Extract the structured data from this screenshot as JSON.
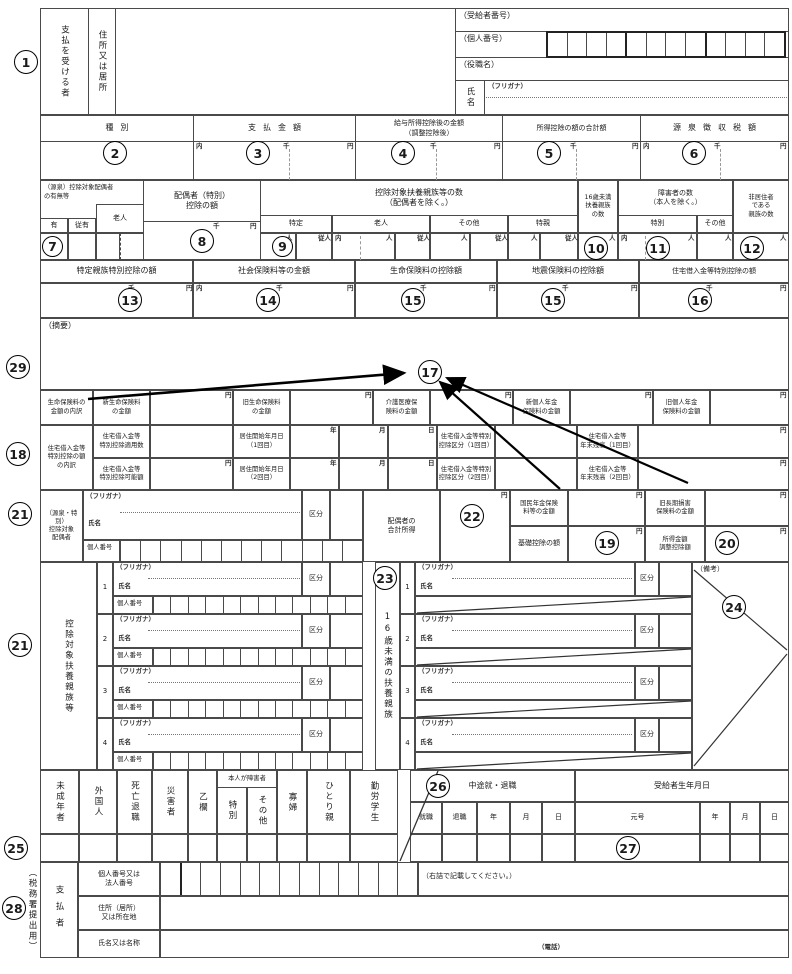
{
  "markers": {
    "m1": "1",
    "m2": "2",
    "m3": "3",
    "m4": "4",
    "m5": "5",
    "m6": "6",
    "m7": "7",
    "m8": "8",
    "m9": "9",
    "m10": "10",
    "m11": "11",
    "m12": "12",
    "m13": "13",
    "m14": "14",
    "m15": "15",
    "m16": "16",
    "m17": "17",
    "m18": "18",
    "m19": "19",
    "m20": "20",
    "m21": "21",
    "m22": "22",
    "m23": "23",
    "m24": "24",
    "m25": "25",
    "m26": "26",
    "m27": "27",
    "m28": "28",
    "m29": "29"
  },
  "units": {
    "uchi": "内",
    "sen": "千",
    "yen": "円",
    "nin": "人",
    "junin": "従人",
    "nen": "年",
    "tsuki": "月",
    "hi": "日"
  },
  "common": {
    "furigana": "（フリガナ）",
    "shimei": "氏名",
    "kojin_bango": "個人番号",
    "kubun": "区分"
  },
  "recipient": {
    "payee": "支払を受ける者",
    "address": "住所又は居所",
    "recipient_no": "（受給者番号）",
    "personal_no": "（個人番号）",
    "position": "（役職名）",
    "name": "氏名"
  },
  "pay": {
    "type": "種別",
    "amount": "支払金額",
    "after_deduction": "給与所得控除後の金額\n（調整控除後）",
    "total_deductions": "所得控除の額の合計額",
    "withheld_tax": "源泉徴収税額"
  },
  "household": {
    "spouse_status": "（源泉）控除対象配偶者\nの有無等",
    "rojin": "老人",
    "ari": "有",
    "juari": "従有",
    "spouse_deduction": "配偶者（特別）\n控除の額",
    "dependents_count": "控除対象扶養親族等の数\n（配偶者を除く。）",
    "tokutei": "特定",
    "sonota": "その他",
    "tokushin": "特親",
    "under16": "16歳未満\n扶養親族\nの数",
    "disabled": "障害者の数\n（本人を除く。）",
    "tokubetsu": "特別",
    "nonresident": "非居住者\nである\n親族の数"
  },
  "deductions": {
    "tokutei_shinzoku": "特定親族特別控除の額",
    "shakai_hoken": "社会保険料等の金額",
    "seimei_hoken": "生命保険料の控除額",
    "jishin_hoken": "地震保険料の控除額",
    "jutaku": "住宅借入金等特別控除の額"
  },
  "summary": {
    "label": "（摘要）"
  },
  "insurance": {
    "breakdown": "生命保険料の\n金額の内訳",
    "shin_seimei": "新生命保険料\nの金額",
    "kyu_seimei": "旧生命保険料\nの金額",
    "kaigo": "介護医療保\n険料の金額",
    "shin_nenkin": "新個人年金\n保険料の金額",
    "kyu_nenkin": "旧個人年金\n保険料の金額"
  },
  "housing": {
    "breakdown": "住宅借入金等\n特別控除の額\nの内訳",
    "tekiyosu": "住宅借入金等\n特別控除適用数",
    "start1": "居住開始年月日\n（1回目）",
    "kubun1": "住宅借入金等特別\n控除区分（1回目）",
    "zandaka1": "住宅借入金等\n年末残高（1回目）",
    "kanogaku": "住宅借入金等\n特別控除可能額",
    "start2": "居住開始年月日\n（2回目）",
    "kubun2": "住宅借入金等特別\n控除区分（2回目）",
    "zandaka2": "住宅借入金等\n年末残高（2回目）"
  },
  "spouse": {
    "label": "（源泉・特別）\n控除対象\n配偶者",
    "total_income": "配偶者の\n合計所得",
    "kokumin_nenkin": "国民年金保険\n料等の金額",
    "kyu_choki": "旧長期損害\n保険料の金額",
    "kiso_kojo": "基礎控除の額",
    "chosei_kojo": "所得金額\n調整控除額"
  },
  "dependents": {
    "left_label": "控除対象扶養親族等",
    "right_label": "16歳未満の扶養親族",
    "rows": [
      "1",
      "2",
      "3",
      "4"
    ],
    "biko": "（備考）"
  },
  "flags": {
    "minor": "未成年者",
    "foreigner": "外国人",
    "death_retire": "死亡退職",
    "disaster": "災害者",
    "otsuran": "乙欄",
    "self_disabled": "本人が障害者",
    "tokubetsu": "特別",
    "sonota": "その他",
    "kafu": "寡婦",
    "hitorioya": "ひとり親",
    "working_student": "勤労学生",
    "midterm": "中途就・退職",
    "shushoku": "就職",
    "taishoku": "退職",
    "birthdate": "受給者生年月日",
    "gengo": "元号"
  },
  "payer": {
    "margin_note": "（税務署提出用）",
    "label": "支払者",
    "number_label": "個人番号又は\n法人番号",
    "right_align_note": "（右詰で記載してください。）",
    "address_label": "住所（居所）\n又は所在地",
    "name_label": "氏名又は名称",
    "tel": "（電話）"
  }
}
